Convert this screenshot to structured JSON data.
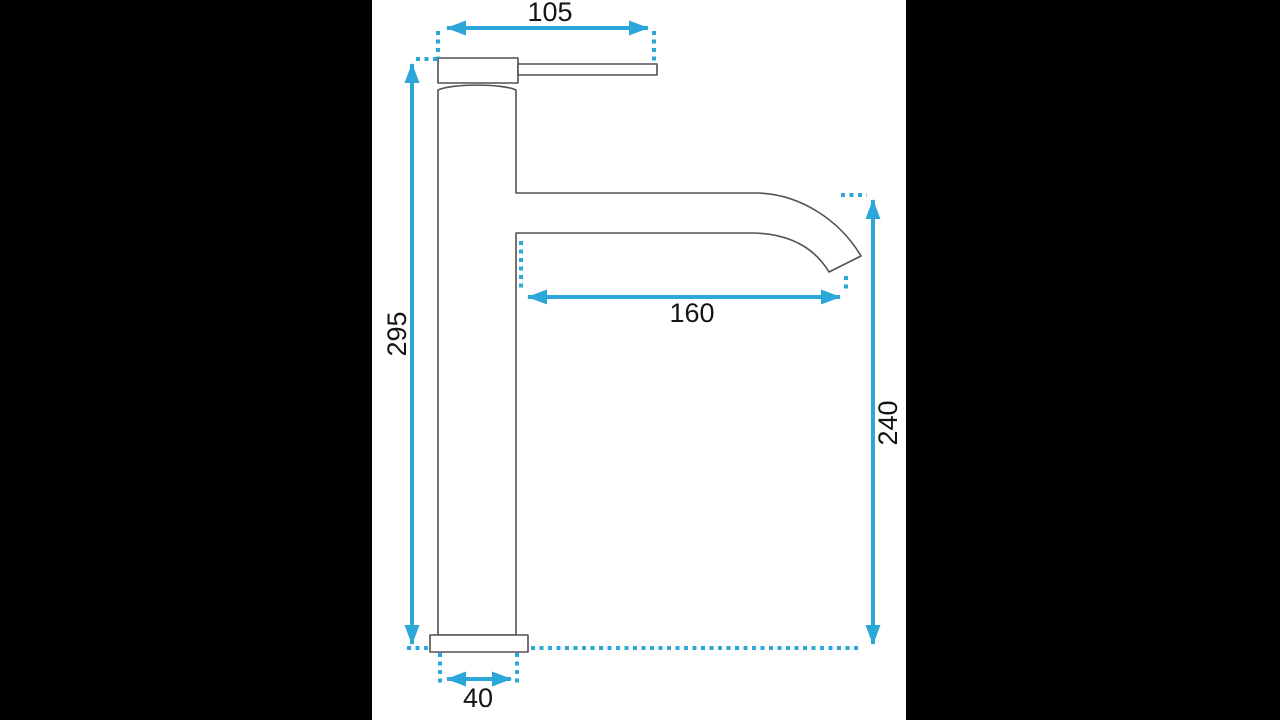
{
  "scene": {
    "subject": "tall single-lever basin faucet side elevation with dimensions",
    "backdrop_color": "#000000",
    "sheet_color": "#ffffff",
    "outline_color": "#4f5154",
    "dimension_color": "#2ba7da",
    "label_color": "#141414"
  },
  "dimensions": {
    "top_length": {
      "value": "105",
      "orientation": "horizontal",
      "position": "top, across lever"
    },
    "overall_height": {
      "value": "295",
      "orientation": "vertical",
      "position": "left, full body height"
    },
    "spout_reach": {
      "value": "160",
      "orientation": "horizontal",
      "position": "middle, under spout"
    },
    "outlet_height": {
      "value": "240",
      "orientation": "vertical",
      "position": "right, spout to base line"
    },
    "base_width": {
      "value": "40",
      "orientation": "horizontal",
      "position": "bottom, under base"
    }
  }
}
